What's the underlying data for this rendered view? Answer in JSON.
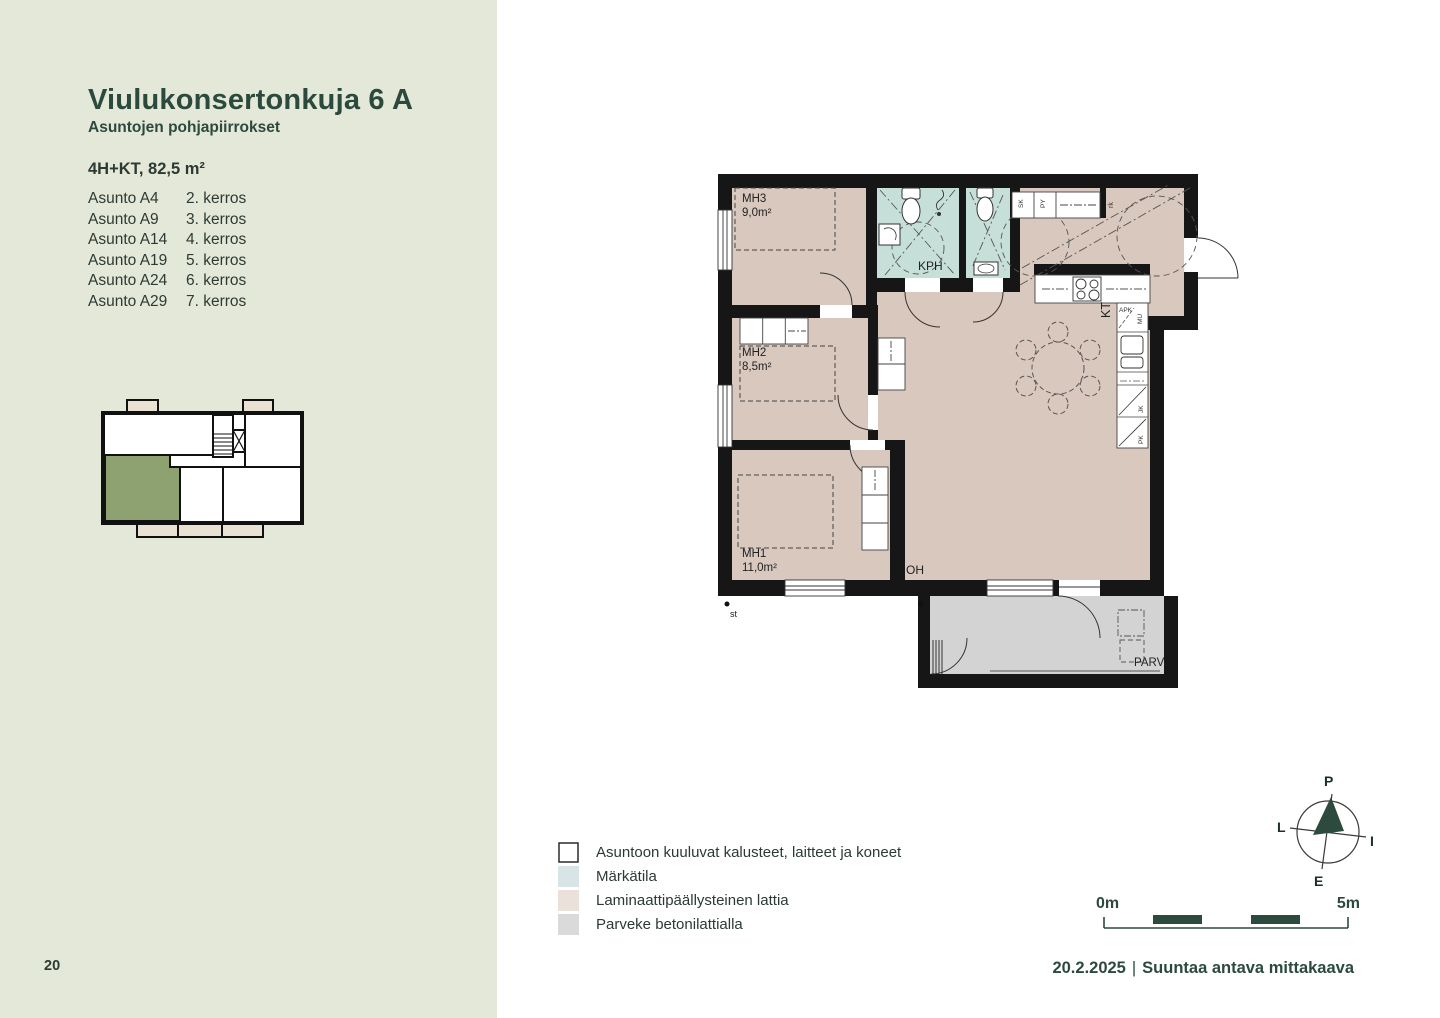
{
  "page": {
    "number": "20"
  },
  "sidebar": {
    "title": "Viulukonsertonkuja 6 A",
    "subtitle": "Asuntojen pohjapiirrokset",
    "apartment_type": "4H+KT, 82,5 m²",
    "apartments": [
      {
        "name": "Asunto A4",
        "floor": "2. kerros"
      },
      {
        "name": "Asunto A9",
        "floor": "3. kerros"
      },
      {
        "name": "Asunto A14",
        "floor": "4. kerros"
      },
      {
        "name": "Asunto A19",
        "floor": "5. kerros"
      },
      {
        "name": "Asunto A24",
        "floor": "6. kerros"
      },
      {
        "name": "Asunto A29",
        "floor": "7. kerros"
      }
    ],
    "keyplan_colors": {
      "highlight": "#8da171",
      "balcony": "#e9e2d3",
      "wall": "#111111"
    }
  },
  "floor_plan": {
    "rooms": {
      "mh3": {
        "name": "MH3",
        "area": "9,0m²"
      },
      "mh2": {
        "name": "MH2",
        "area": "8,5m²"
      },
      "mh1": {
        "name": "MH1",
        "area": "11,0m²"
      },
      "kph": {
        "name": "KPH"
      },
      "oh": {
        "name": "OH"
      },
      "kt": {
        "name": "KT"
      },
      "parv": {
        "name": "PARV."
      }
    },
    "fixtures": {
      "sk": "SK",
      "py": "PY",
      "rk": "rk",
      "apk": "APK",
      "mu": "MU",
      "jk": "JK",
      "pk": "PK",
      "st": "st"
    },
    "colors": {
      "laminate": "#d9c8be",
      "wet_room": "#c7dfd9",
      "balcony": "#d3d3d3",
      "wall": "#161616"
    }
  },
  "legend": {
    "items": [
      {
        "label": "Asuntoon kuuluvat kalusteet, laitteet ja koneet",
        "swatch": "#ffffff"
      },
      {
        "label": "Märkätila",
        "swatch": "#d8e4e6"
      },
      {
        "label": "Laminaattipäällysteinen lattia",
        "swatch": "#eae1da"
      },
      {
        "label": "Parveke betonilattialla",
        "swatch": "#dadada"
      }
    ]
  },
  "compass": {
    "north": "P",
    "east": "I",
    "south": "E",
    "west": "L",
    "color": "#2d4a3e"
  },
  "scale_bar": {
    "start_label": "0m",
    "end_label": "5m",
    "bar_color": "#2d4a3e"
  },
  "footer": {
    "date": "20.2.2025",
    "separator": "|",
    "note": "Suuntaa antava mittakaava"
  }
}
